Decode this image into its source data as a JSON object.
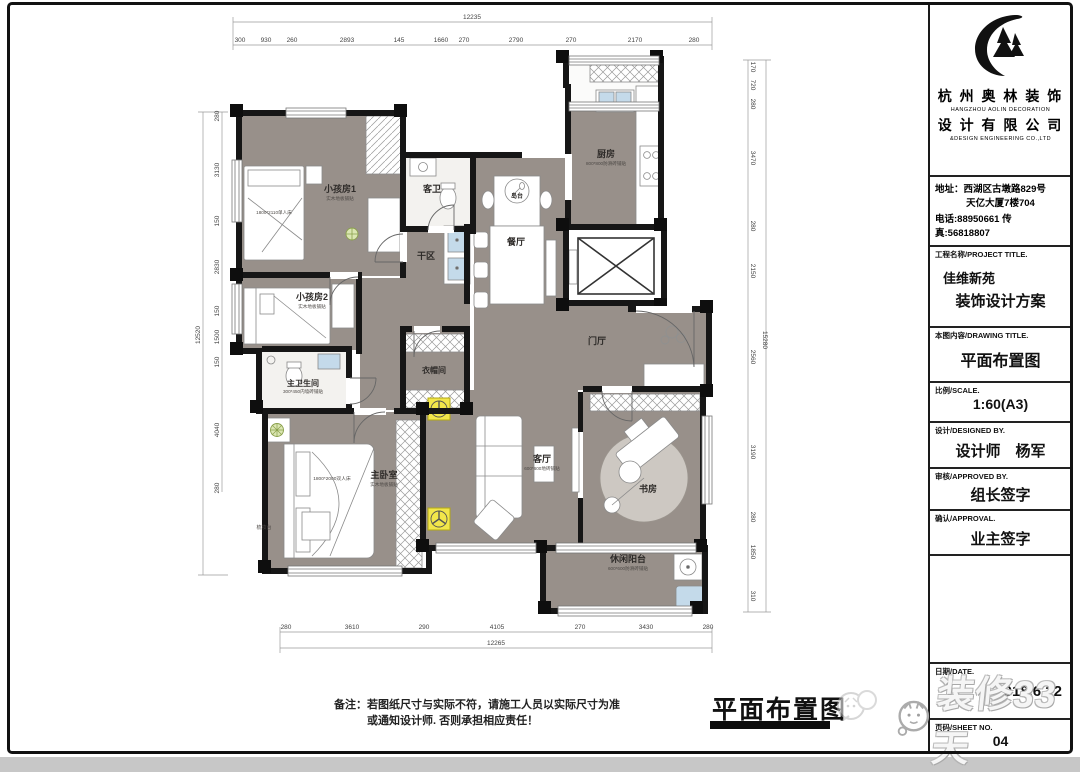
{
  "titleblock": {
    "company_cn": "杭 州 奥 林 装 饰",
    "company_en": "HANGZHOU  AOLIN  DECORATION",
    "company_cn2": "设 计 有 限 公 司",
    "company_en2": "&DESIGN ENGINEERING CO.,LTD",
    "address1": "地址：西湖区古墩路829号",
    "address2": "天亿大厦7楼704",
    "phone": "电话:88950661 传真:56818807",
    "project_label": "工程名称/PROJECT TITLE.",
    "project_name": "佳维新苑",
    "project_name2": "装饰设计方案",
    "drawing_label": "本图内容/DRAWING TITLE.",
    "drawing_title": "平面布置图",
    "scale_label": "比例/SCALE.",
    "scale_value": "1:60(A3)",
    "designed_label": "设计/DESIGNED BY.",
    "designer": "设计师　杨军",
    "approved_label": "审核/APPROVED BY.",
    "approver": "组长签字",
    "approval_label": "确认/APPROVAL.",
    "approval": "业主签字",
    "date_label": "日期/DATE.",
    "date_value": "2018.6.22",
    "sheet_label": "页码/SHEET NO.",
    "sheet_value": "04"
  },
  "footer": {
    "note_label": "备注：",
    "note_line1": "若图纸尺寸与实际不符，请施工人员以实际尺寸为准",
    "note_line2": "或通知设计师. 否则承担相应责任！",
    "big_title": "平面布置图"
  },
  "watermark": {
    "brand": "装修33天"
  },
  "plan": {
    "rooms": {
      "kids1": {
        "name": "小孩房1",
        "sub": "实木地板铺贴"
      },
      "kids2": {
        "name": "小孩房2",
        "sub": "实木地板铺贴"
      },
      "gbath": {
        "name": "客卫"
      },
      "kitchen": {
        "name": "厨房",
        "sub": "800*800防滑砖铺贴"
      },
      "island": {
        "name": "岛台"
      },
      "dining": {
        "name": "餐厅"
      },
      "dryarea": {
        "name": "干区"
      },
      "mbath": {
        "name": "主卫生间",
        "sub": "300*450内墙砖铺贴"
      },
      "cloak": {
        "name": "衣帽间"
      },
      "foyer": {
        "name": "门厅"
      },
      "master": {
        "name": "主卧室",
        "sub": "实木地板铺贴"
      },
      "living": {
        "name": "客厅",
        "sub": "600*600地砖铺贴"
      },
      "study": {
        "name": "书房"
      },
      "balcony": {
        "name": "休闲阳台",
        "sub": "600*600防滑砖铺贴"
      }
    },
    "furniture_labels": {
      "kids_bed": "1800*2110单人床",
      "master_bed": "1800*2000双人床",
      "dresser": "梳妆台"
    },
    "dims": {
      "top_total": "12235",
      "top": [
        "300",
        "930",
        "260",
        "2893",
        "145",
        "1660",
        "270",
        "2790",
        "270",
        "2170",
        "280"
      ],
      "bottom_total": "12265",
      "bottom": [
        "280",
        "3610",
        "290",
        "4105",
        "270",
        "3430",
        "280"
      ],
      "left_total": "12520",
      "left": [
        "280",
        "3130",
        "150",
        "2830",
        "150",
        "1500",
        "150",
        "4040",
        "280"
      ],
      "right_total": "15280",
      "right": [
        "170",
        "720",
        "280",
        "3470",
        "280",
        "2150",
        "2560",
        "3190",
        "280",
        "1850",
        "310"
      ]
    },
    "colors": {
      "floor": "#98908a",
      "wall": "#161616",
      "accent_yellow": "#f2e64a",
      "sink_blue": "#c4daea"
    }
  }
}
